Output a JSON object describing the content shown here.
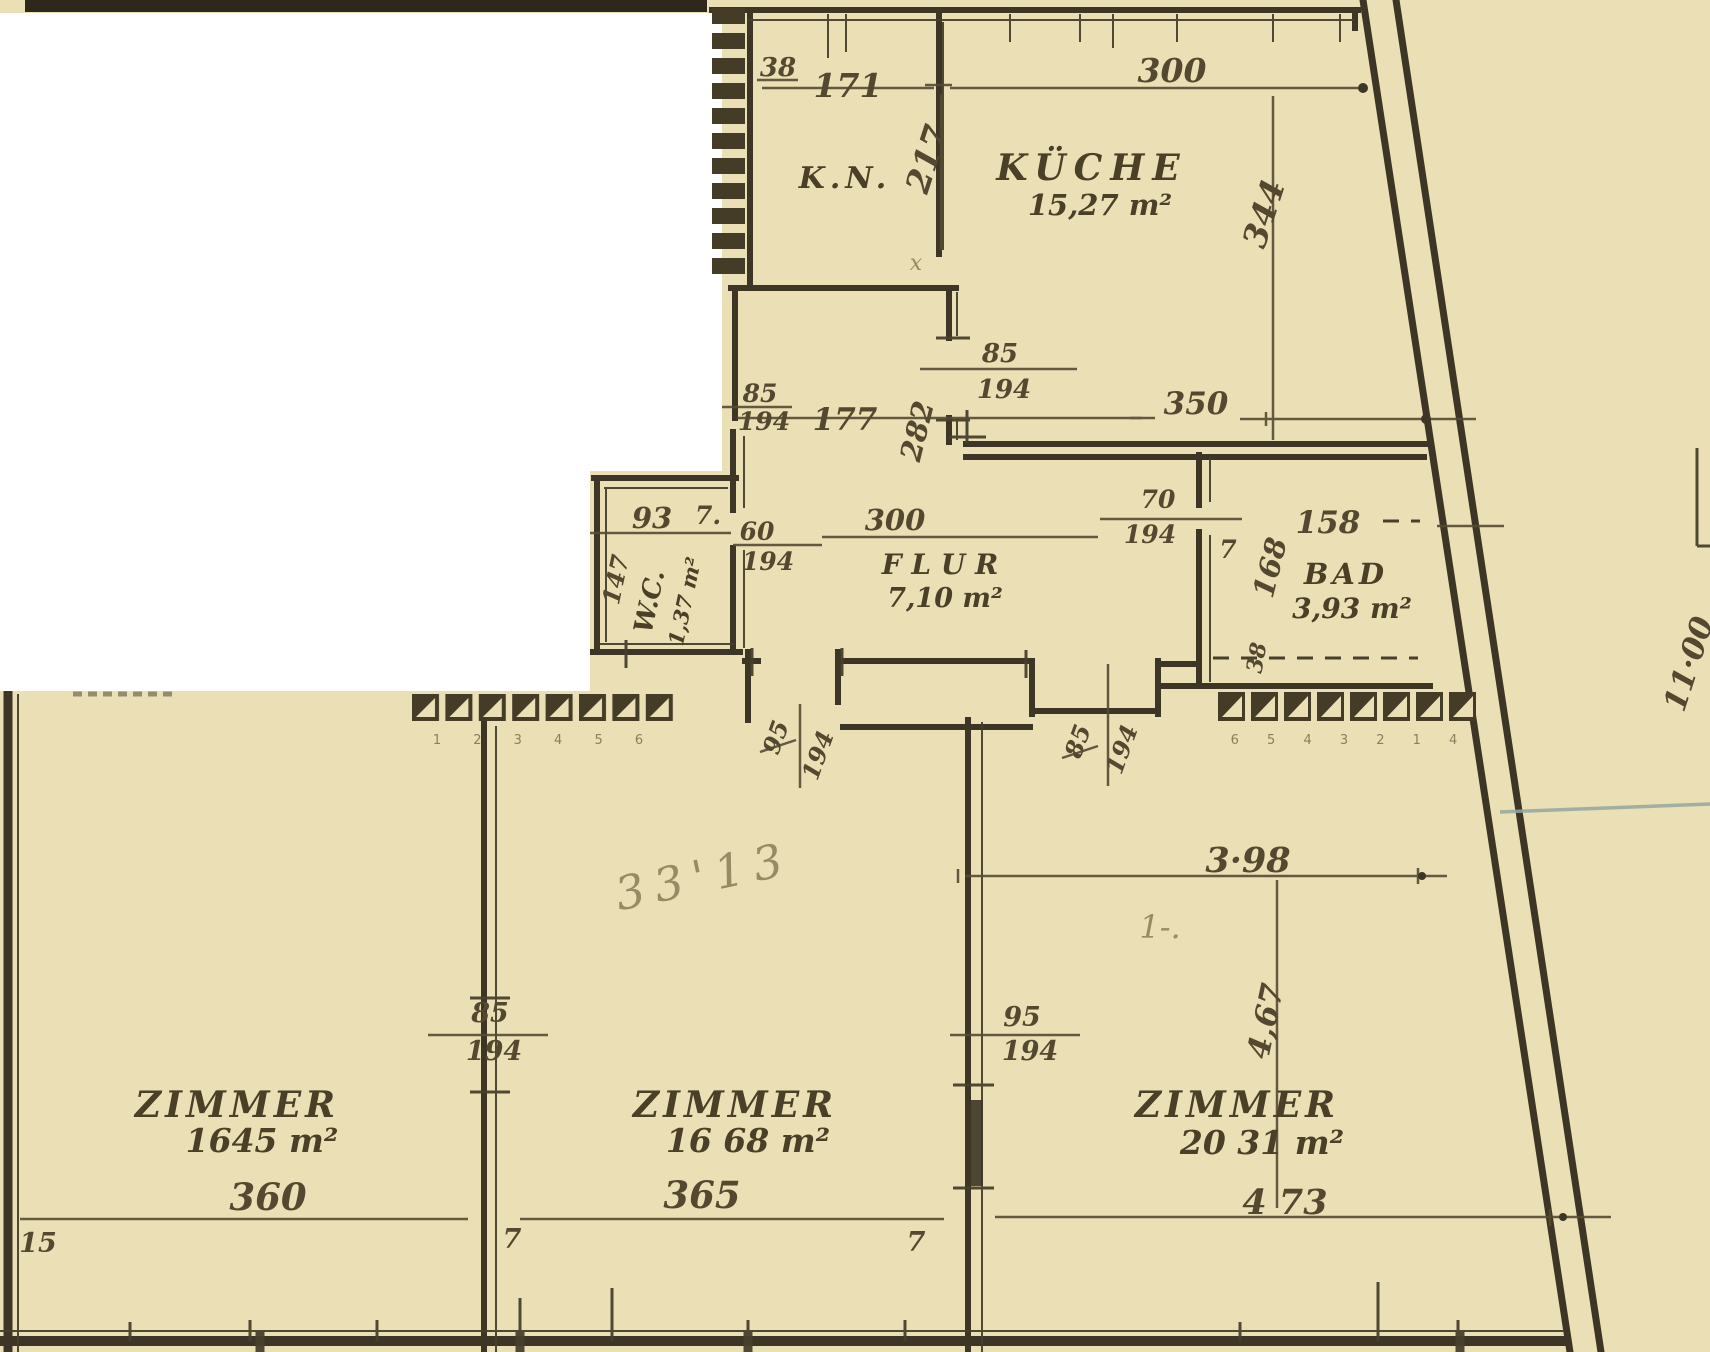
{
  "colors": {
    "paper": "#eadfb5",
    "ink": "#3d3526",
    "dim_line": "#564b34",
    "pencil": "#8a7c57",
    "survey_line": "#93a7a0",
    "scan_white": "#ffffff"
  },
  "rooms": {
    "kn": {
      "label": "K.N."
    },
    "kueche": {
      "label": "KÜCHE",
      "area": "15,27 m²"
    },
    "flur": {
      "label": "F L U R",
      "area": "7,10 m²"
    },
    "wc": {
      "label": "W.C.",
      "area": "1,37 m²"
    },
    "bad": {
      "label": "BAD",
      "area": "3,93 m²"
    },
    "zimmer1": {
      "label": "ZIMMER",
      "area": "1645 m²"
    },
    "zimmer2": {
      "label": "ZIMMER",
      "area": "16 68 m²"
    },
    "zimmer3": {
      "label": "ZIMMER",
      "area": "20 31 m²"
    }
  },
  "dims": {
    "kn_offset": "38",
    "kn_width": "171",
    "kn_depth": "217",
    "kueche_width": "300",
    "kueche_depth": "344",
    "kueche_south": "350",
    "closet_width": "177",
    "closet_depth": "282",
    "wc_offset": "93",
    "wc_sep": "7.",
    "wc_depth": "147",
    "flur_width": "300",
    "bad_width": "158",
    "bad_depth": "168",
    "bad_offset": "38",
    "bad_sep": "7",
    "z3_upper_width": "3·98",
    "z3_depth": "4,67",
    "z3_width": "4 73",
    "z1_width": "360",
    "z1_offset": "15",
    "z2_width": "365",
    "z2_sep_left": "7",
    "z2_sep_right": "7"
  },
  "doors": {
    "kueche_flur": {
      "w": "85",
      "h": "194"
    },
    "closet": {
      "w": "85",
      "h": "194"
    },
    "wc": {
      "w": "60",
      "h": "194"
    },
    "bad": {
      "w": "70",
      "h": "194"
    },
    "flur_zimmer2": {
      "w": "95",
      "h": "194"
    },
    "flur_zimmer3": {
      "w": "85",
      "h": "194"
    },
    "zimmer1_2": {
      "w": "85",
      "h": "194"
    },
    "zimmer2_3": {
      "w": "95",
      "h": "194"
    }
  },
  "site": {
    "boundary_length": "11·00"
  },
  "pencil_notes": {
    "note": "33'13",
    "mark": "1-.",
    "corner_mark": "x"
  },
  "window_rows": {
    "left_digits": "1 2 3 4 5 6",
    "right_digits": "6 5 4 3 2 1 4"
  }
}
